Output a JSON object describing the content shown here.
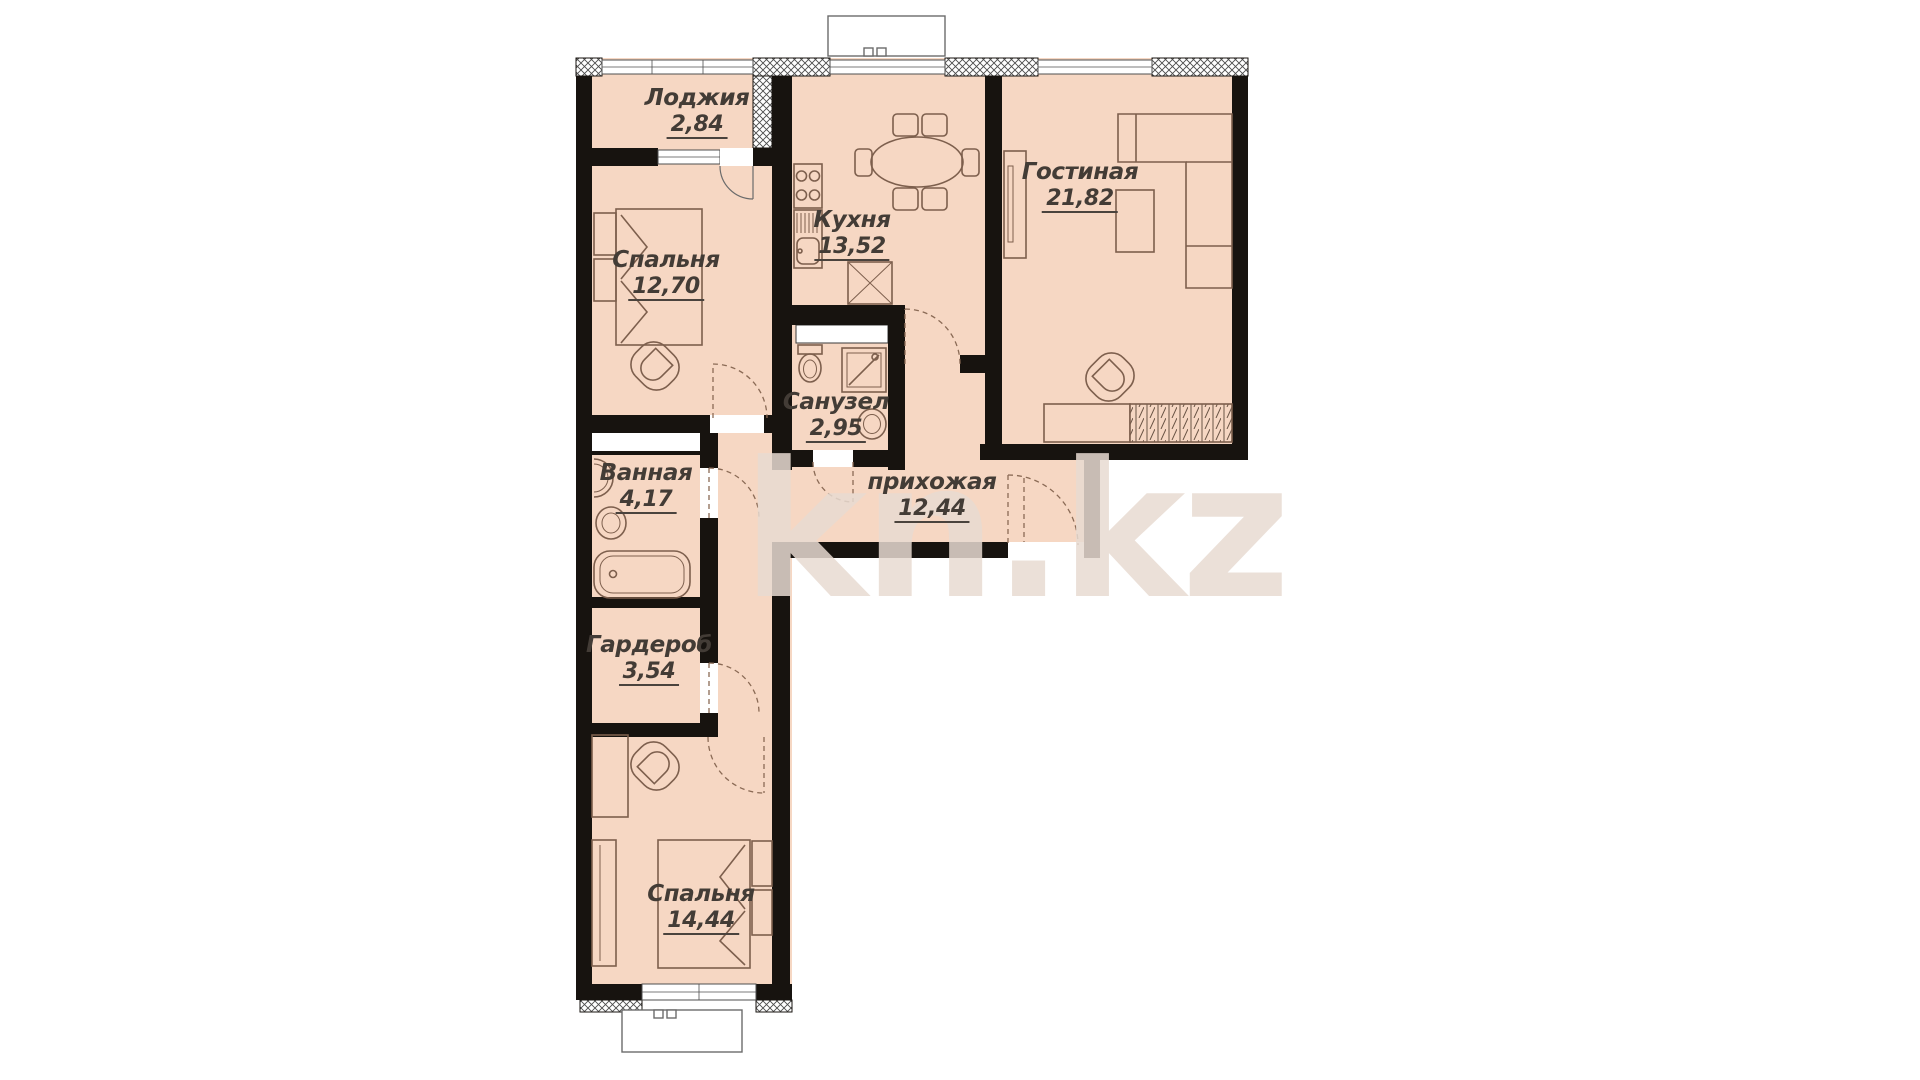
{
  "watermark": "kn.kz",
  "rooms": [
    {
      "key": "loggia",
      "name": "Лоджия",
      "area": "2,84"
    },
    {
      "key": "bedroom-1",
      "name": "Спальня",
      "area": "12,70"
    },
    {
      "key": "kitchen",
      "name": "Кухня",
      "area": "13,52"
    },
    {
      "key": "living-room",
      "name": "Гостиная",
      "area": "21,82"
    },
    {
      "key": "wc",
      "name": "Санузел",
      "area": "2,95"
    },
    {
      "key": "bathroom",
      "name": "Ванная",
      "area": "4,17"
    },
    {
      "key": "hallway",
      "name": "прихожая",
      "area": "12,44"
    },
    {
      "key": "wardrobe",
      "name": "Гардероб",
      "area": "3,54"
    },
    {
      "key": "bedroom-2",
      "name": "Спальня",
      "area": "14,44"
    }
  ],
  "colors": {
    "background": "#ffffff",
    "floor": "#f6d7c3",
    "walls": "#17130f",
    "furniture_outline": "#7d5f4d",
    "label_text": "#433c36",
    "watermark": "#e7dad1"
  },
  "furniture_icons": [
    "double-bed",
    "nightstand",
    "armchair",
    "dining-table",
    "chair",
    "stove",
    "kitchen-sink",
    "fridge",
    "corner-sofa",
    "tv-stand",
    "coffee-table",
    "cabinet",
    "closet-hatched",
    "shower-cabin",
    "toilet",
    "washbasin",
    "bathtub",
    "desk",
    "sliding-wardrobe",
    "entrance-door",
    "interior-door-arc",
    "window",
    "balcony"
  ]
}
